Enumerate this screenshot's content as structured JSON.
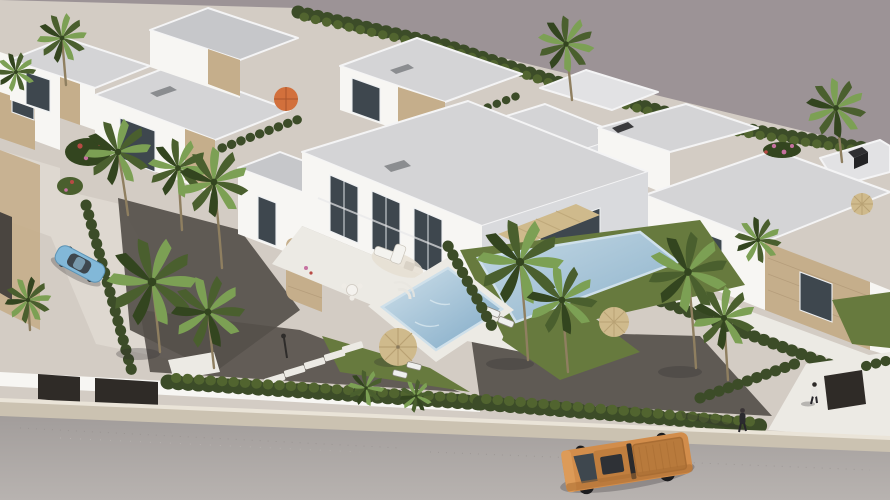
{
  "meta": {
    "description": "Aerial 3D architectural rendering of a modern residential development: rows of white flat-roofed villas with stone accents, private pools, palm trees and clipped hedges; a grey street with an orange pickup truck and two pedestrians runs along the bottom; plain warm-grey backdrop fills the upper right.",
    "view": "high-angle aerial, sunlight from upper right, soft shadows toward lower left"
  },
  "palette": {
    "bg": "#9c9396",
    "ground": "#d3ccc4",
    "ground_light": "#ded8d0",
    "road_top": "#a29d9b",
    "road_bottom": "#b8b3b0",
    "sidewalk": "#cbc2b1",
    "curb": "#eae4d8",
    "wall_white": "#f7f6f3",
    "wall_shade": "#d9dadd",
    "roof": "#d4d4d6",
    "roof_dark": "#c6c7ca",
    "roof_light": "#e2e2e4",
    "rim": "#f4f4f5",
    "glass": "#3e474e",
    "stone": "#c5ae8b",
    "stone_dark": "#a8906f",
    "hedge": "#3c4c28",
    "hedge_light": "#51642f",
    "grass": "#677a3e",
    "gravel": "#55504a",
    "deck": "#eceae4",
    "pool_light": "#cfe0ea",
    "pool_deep": "#7fa9c6",
    "straw": "#cfba8c",
    "straw_dark": "#b9a274",
    "orange_umbrella": "#d2703c",
    "truck": "#d28d4b",
    "truck_dark": "#a96d33",
    "truck_bed": "#b87a3c",
    "car": "#82b8d8",
    "trunk": "#8f7f60",
    "palm": "#7ca054",
    "palm_dark": "#4a5f2e",
    "palm_deep": "#33451f",
    "flower_red": "#b84a44",
    "flower_pink": "#c671a0",
    "shadow_c": "rgba(45,42,48,0.28)"
  },
  "scene": {
    "background": "plain warm-grey unmodelled ground, upper right",
    "street": {
      "surface": "light grey asphalt along bottom edge",
      "sidewalk": "beige gravel strip with white boundary wall and gates",
      "vehicles": [
        {
          "type": "pickup-truck",
          "color_key": "truck",
          "location": "bottom center-right",
          "details": "open ribbed bed, dark windshield, black wheels"
        },
        {
          "type": "hatchback-car",
          "color_key": "car",
          "location": "driveway center-left",
          "details": "light blue, parked at an angle"
        }
      ],
      "pedestrians": [
        {
          "description": "figure in dark clothes crossing the road, long shadow pointing left",
          "location": "right of truck"
        },
        {
          "description": "figure in white shirt at the right villa driveway gate",
          "location": "lower right"
        }
      ]
    },
    "main_villa": {
      "stories": 2,
      "features": [
        "flat grey roof with light parapet",
        "floor-to-ceiling dark glazing",
        "beige canvas awning over terrace",
        "curved stone-clad accent wall",
        "white outdoor corner sofa",
        "round dining table"
      ]
    },
    "pools": [
      {
        "location": "front garden of main villa",
        "shape": "rectangular, rotated",
        "details": "curved corner steps, pale deck"
      },
      {
        "location": "neighbouring garden to the right",
        "shape": "rectangular, partly behind palms"
      }
    ],
    "landscaping": {
      "palm_trees": 16,
      "hedges": "clipped dark-green rows along street and plot boundaries",
      "lawns": "small bright green patches around the pools",
      "gravel_beds": "dark decorative gravel with stepping-stone path and lamp post",
      "parasols": [
        {
          "type": "straw",
          "count": 3
        },
        {
          "type": "orange-fabric",
          "count": 1
        }
      ],
      "flowers": [
        "red bougainvillea shrubs (left)",
        "pink bougainvillea (right)"
      ]
    },
    "other_villas": "rows of matching white flat-roofed villas with tan stone accents recede to the upper left, top and right"
  }
}
